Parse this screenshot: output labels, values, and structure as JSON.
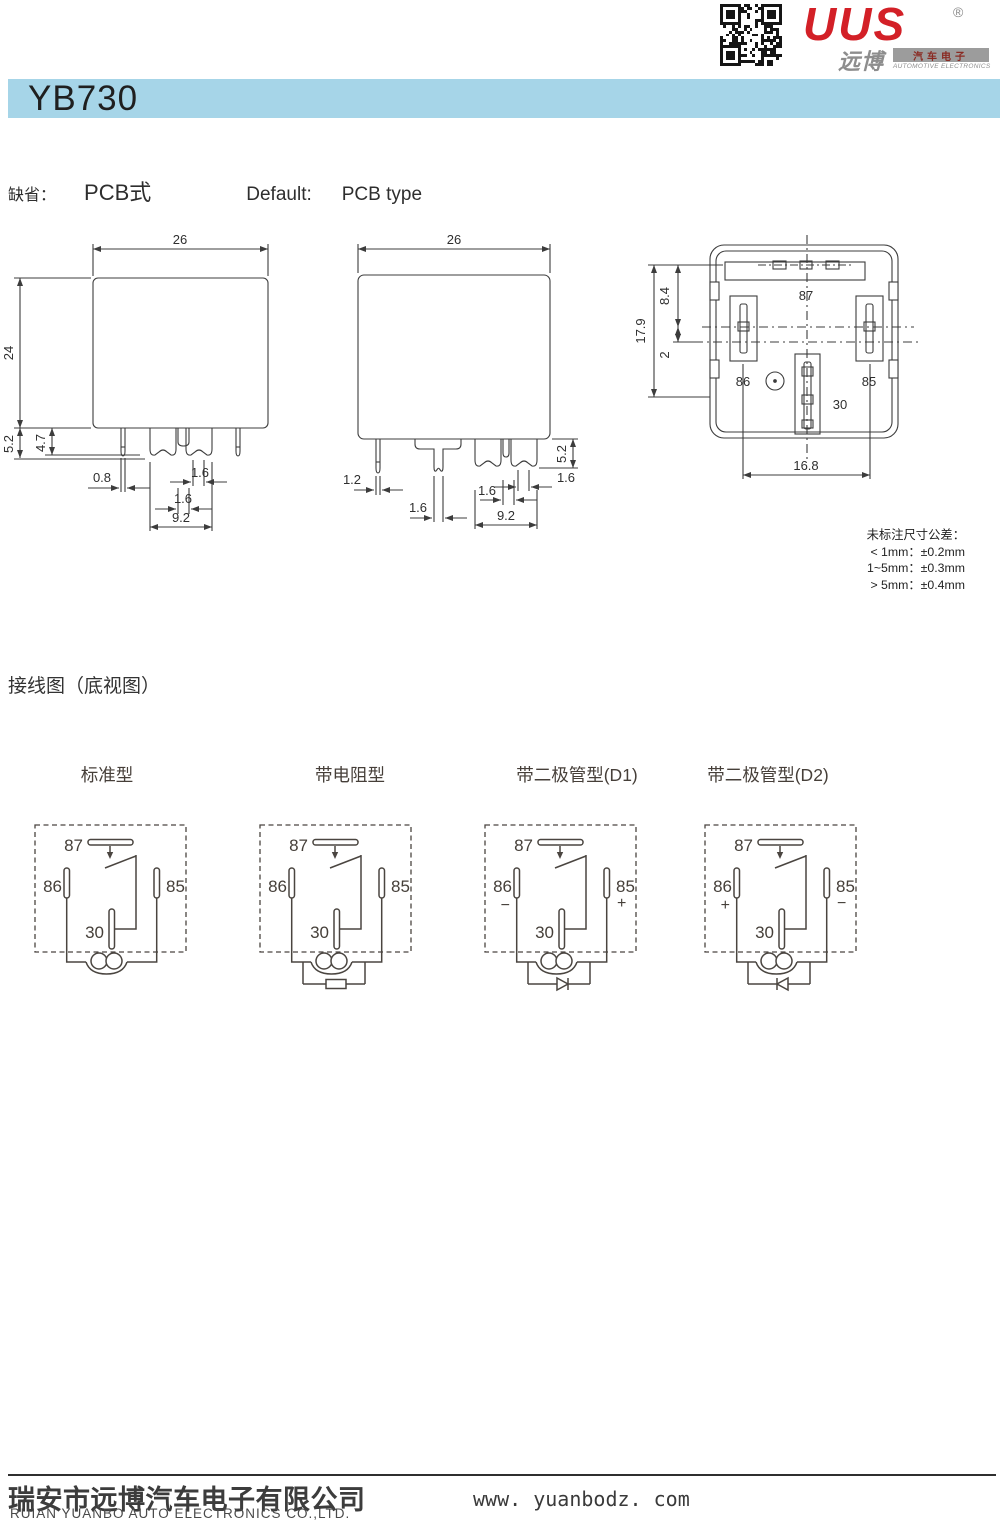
{
  "brand": {
    "logo_text": "UUS",
    "registered": "®",
    "logo_cn": "远博",
    "sub_cn": "汽车电子",
    "sub_en": "AUTOMOTIVE ELECTRONICS",
    "logo_red": "#d32027"
  },
  "header": {
    "model": "YB730",
    "bar_color": "#a6d5e8"
  },
  "default_line": {
    "label_cn": "缺省：",
    "value_cn": "PCB式",
    "label_en": "Default:",
    "value_en": "PCB type"
  },
  "drawings": {
    "front_view": {
      "dim_width": "26",
      "dim_height": "24",
      "dim_pin_total": "5.2",
      "dim_pin_round": "4.7",
      "dim_round_w": "0.8",
      "dim_blade_upper": "1.6",
      "dim_blade_lower": "1.6",
      "dim_pitch": "9.2"
    },
    "side_view": {
      "dim_width": "26",
      "dim_round_w": "1.2",
      "dim_blade_mid": "1.6",
      "dim_blade_lower": "1.6",
      "dim_blade_upper": "1.6",
      "dim_pitch": "9.2",
      "dim_pin_total": "5.2"
    },
    "bottom_view": {
      "pin_87": "87",
      "pin_86": "86",
      "pin_85": "85",
      "pin_30": "30",
      "dim_total": "17.9",
      "dim_upper": "8.4",
      "dim_center": "2",
      "dim_width": "16.8"
    },
    "tolerance_note": {
      "title": "未标注尺寸公差：",
      "row1": "< 1mm：±0.2mm",
      "row2": "1~5mm：±0.3mm",
      "row3": "> 5mm：±0.4mm"
    }
  },
  "wiring": {
    "section_title": "接线图（底视图）",
    "diagrams": [
      {
        "title": "标准型",
        "type": "standard",
        "pin_87": "87",
        "pin_86": "86",
        "pin_85": "85",
        "pin_30": "30",
        "sign_86": "",
        "sign_85": ""
      },
      {
        "title": "带电阻型",
        "type": "resistor",
        "pin_87": "87",
        "pin_86": "86",
        "pin_85": "85",
        "pin_30": "30",
        "sign_86": "",
        "sign_85": ""
      },
      {
        "title": "带二极管型(D1)",
        "type": "diode-d1",
        "pin_87": "87",
        "pin_86": "86",
        "pin_85": "85",
        "pin_30": "30",
        "sign_86": "−",
        "sign_85": "+"
      },
      {
        "title": "带二极管型(D2)",
        "type": "diode-d2",
        "pin_87": "87",
        "pin_86": "86",
        "pin_85": "85",
        "pin_30": "30",
        "sign_86": "+",
        "sign_85": "−"
      }
    ]
  },
  "footer": {
    "company_cn": "瑞安市远博汽车电子有限公司",
    "company_en": "RUIAN YUANBO AUTO ELECTRONICS CO.,LTD.",
    "website": "www. yuanbodz. com"
  }
}
